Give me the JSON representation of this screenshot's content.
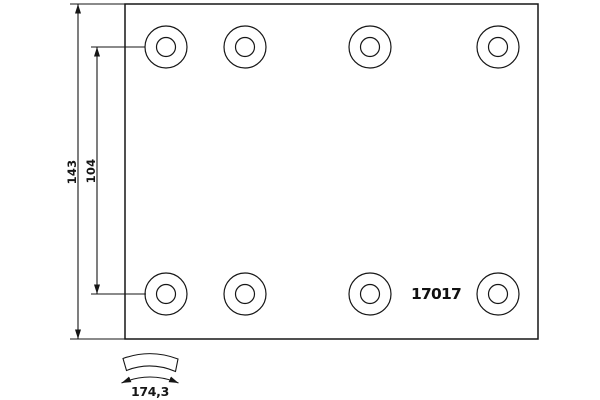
{
  "labels": {
    "part_number": "17017",
    "overall_width_mm": "143",
    "rivet_hole_spacing_mm": "104",
    "arc_length_mm": "174,3"
  },
  "colors": {
    "background": "#ffffff",
    "line": "#161616"
  },
  "holes": {
    "count": 8,
    "columns_x": [
      166,
      245,
      370,
      498
    ],
    "rows_y": [
      47,
      294
    ],
    "outer_radius": 21,
    "inner_radius": 9.5
  }
}
